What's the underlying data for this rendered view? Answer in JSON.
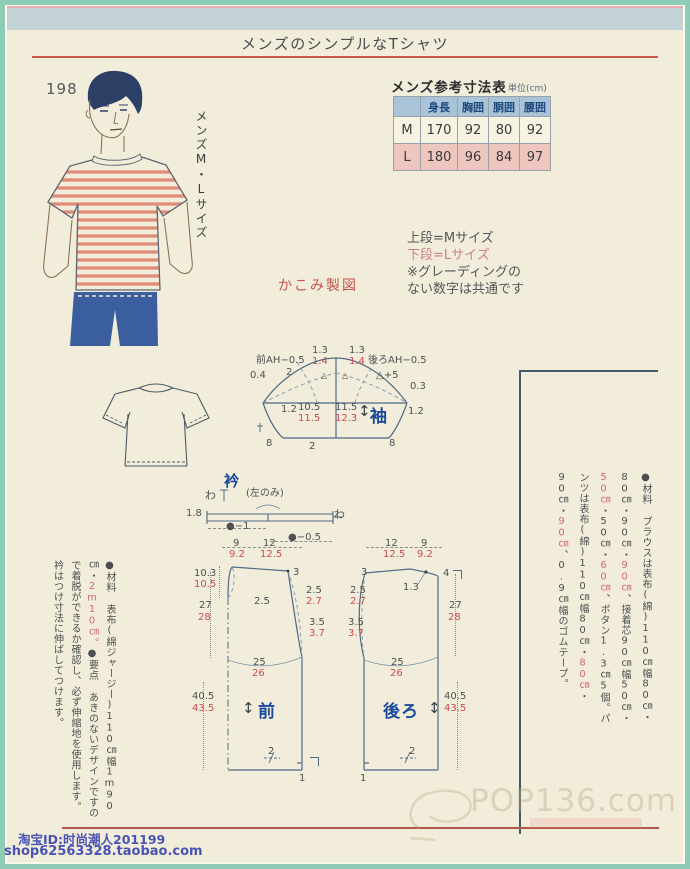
{
  "header": {
    "title": "メンズのシンプルなTシャツ"
  },
  "page_number": "198",
  "size_label": "メンズM・Lサイズ",
  "size_table": {
    "title": "メンズ参考寸法表",
    "unit": "単位(cm)",
    "col_headers": [
      "身長",
      "胸囲",
      "胴囲",
      "腰囲"
    ],
    "rows": [
      {
        "label": "M",
        "height": "170",
        "chest": "92",
        "waist": "80",
        "hip": "92"
      },
      {
        "label": "L",
        "height": "180",
        "chest": "96",
        "waist": "84",
        "hip": "97"
      }
    ]
  },
  "notes": {
    "line1": "上段=Mサイズ",
    "line2": "下段=Lサイズ",
    "line3": "※グレーディングの",
    "line4": "ない数字は共通です"
  },
  "kakomi": "かこみ製図",
  "sleeve": {
    "name": "袖",
    "arrow": "↕",
    "front_ah": "前AH−0.5",
    "back_ah": "後ろAH−0.5",
    "cap1_m": "1.3",
    "cap1_l": "1.4",
    "cap2_m": "1.3",
    "cap2_l": "1.4",
    "v04": "0.4",
    "v2": "2",
    "tri1": "△",
    "tri2": "△",
    "tri_plus5": "△+5",
    "v03": "0.3",
    "left12": "1.2",
    "w1_m": "10.5",
    "w1_l": "11.5",
    "w2_m": "11.5",
    "w2_l": "12.3",
    "right12": "1.2",
    "b_left": "8",
    "b_center": "2",
    "b_right": "8"
  },
  "collar": {
    "name": "衿",
    "fold_left": "わ",
    "left_only": "(左のみ)",
    "fold_right": "わ",
    "h": "1.8",
    "dim1": "●−1",
    "dim2": "●−0.5"
  },
  "front": {
    "name": "前",
    "arrow": "↕",
    "w1_m": "9",
    "w1_l": "9.2",
    "w2_m": "12",
    "w2_l": "12.5",
    "neck_m": "10.3",
    "neck_l": "10.5",
    "upper_m": "27",
    "upper_l": "28",
    "shoulder": "3",
    "neck_depth": "2.5",
    "arm1_m": "2.5",
    "arm1_l": "2.7",
    "arm2_m": "3.5",
    "arm2_l": "3.7",
    "chest_m": "25",
    "chest_l": "26",
    "lower_m": "40.5",
    "lower_l": "43.5",
    "hem2": "2",
    "hem1": "1"
  },
  "back": {
    "name": "後ろ",
    "arrow": "↕",
    "w1_m": "12",
    "w1_l": "12.5",
    "w2_m": "9",
    "w2_l": "9.2",
    "shoulder": "3",
    "cb": "4",
    "neck_depth": "1.3",
    "arm1_m": "2.5",
    "arm1_l": "2.7",
    "arm2_m": "3.5",
    "arm2_l": "3.7",
    "upper_m": "27",
    "upper_l": "28",
    "chest_m": "25",
    "chest_l": "26",
    "lower_m": "40.5",
    "lower_l": "43.5",
    "hem2": "2",
    "hem1": "1"
  },
  "left_column": {
    "s0": "●材料 表布(綿ジャージー)110㎝幅1m90㎝・",
    "s1": "2m10㎝。",
    "s2": "●要点 あきのないデザインですので着脱ができるか確認し、必ず伸縮地を使用します。衿はつけ寸法に伸ばしてつけます。"
  },
  "right_column": {
    "s0": "●材料 ブラウスは表布(綿)110㎝幅80㎝・80㎝・90㎝・",
    "s1": "90㎝",
    "s2": "、接着芯90㎝幅50㎝・",
    "s3": "50㎝",
    "s4": "・50㎝・",
    "s5": "60㎝",
    "s6": "、ボタン1.3㎝5個。パンツは表布(綿)110㎝幅80㎝・",
    "s7": "80㎝",
    "s8": "・90㎝・",
    "s9": "90㎝",
    "s10": "、0.9㎝幅のゴムテープ。"
  },
  "footer": {
    "taobao_id": "淘宝ID:时尚潮人201199",
    "taobao_url": "shop62563328.taobao.com",
    "watermark": "POP136.com"
  }
}
